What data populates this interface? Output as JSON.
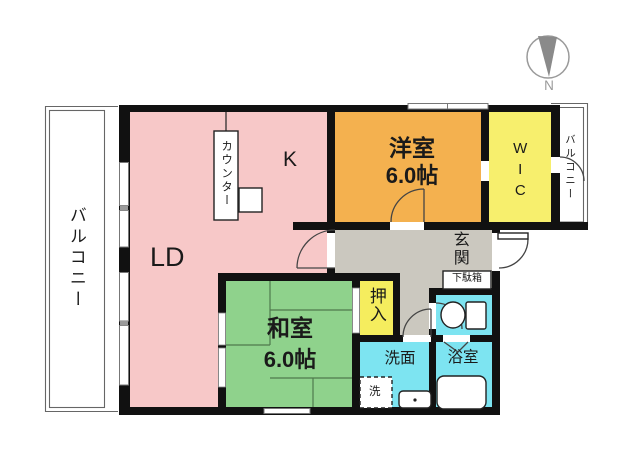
{
  "colors": {
    "ld_kitchen": "#f7c8c8",
    "western_room": "#f4b14f",
    "wic": "#f7ef6d",
    "closet": "#f5ed5e",
    "japanese_room": "#8fd28c",
    "wet_area": "#7de4f1",
    "hallway": "#cbc8bf",
    "wall": "#111111",
    "tatami_line": "#4f7a4c",
    "compass_needle": "#8a8a8a",
    "compass_ring": "#9a9a9a",
    "text": "#1a1a1a"
  },
  "labels": {
    "ld": "LD",
    "kitchen": "K",
    "counter": "カウンター",
    "western_room_name": "洋室",
    "western_room_size": "6.0帖",
    "wic": "WIC",
    "balcony_left": "バルコニー",
    "balcony_right": "バルコニー",
    "japanese_room_name": "和室",
    "japanese_room_size": "6.0帖",
    "closet": "押入",
    "entrance": "玄関",
    "shoe_cabinet": "下駄箱",
    "washroom": "洗面",
    "washing_machine": "洗",
    "bathroom": "浴室",
    "compass_north": "N"
  }
}
